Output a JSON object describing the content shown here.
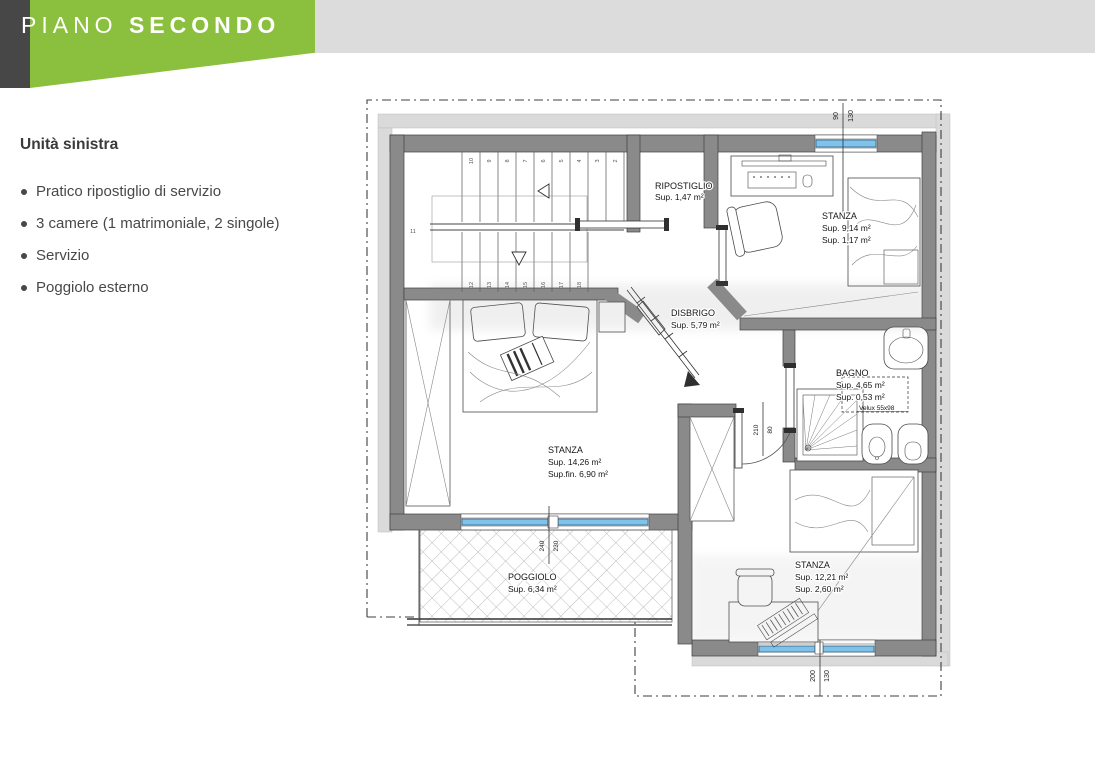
{
  "header": {
    "brand_light": "PIANO",
    "brand_bold": "SECONDO"
  },
  "sidebar": {
    "title": "Unità sinistra",
    "bullets": [
      "Pratico ripostiglio di servizio",
      "3 camere (1 matrimoniale, 2 singole)",
      "Servizio",
      "Poggiolo esterno"
    ]
  },
  "plan": {
    "rooms": {
      "ripostiglio": {
        "name": "RIPOSTIGLIO",
        "area": "Sup. 1,47 m²"
      },
      "stanza_nord": {
        "name": "STANZA",
        "area": "Sup. 9,14 m²",
        "area2": "Sup. 1,17 m²"
      },
      "disbrigo": {
        "name": "DISBRIGO",
        "area": "Sup. 5,79 m²"
      },
      "bagno": {
        "name": "BAGNO",
        "area": "Sup. 4,65 m²",
        "area2": "Sup. 0,53 m²",
        "velux": "Velux 55x98"
      },
      "stanza_matrimoniale": {
        "name": "STANZA",
        "area": "Sup. 14,26 m²",
        "area2": "Sup.fin. 6,90 m²"
      },
      "poggiolo": {
        "name": "POGGIOLO",
        "area": "Sup. 6,34 m²"
      },
      "stanza_sud": {
        "name": "STANZA",
        "area": "Sup. 12,21 m²",
        "area2": "Sup. 2,60 m²"
      }
    },
    "dims": {
      "window_top": [
        "90",
        "130"
      ],
      "door": [
        "210",
        "80"
      ],
      "balcony_window": [
        "240",
        "230"
      ],
      "window_bottom": [
        "200",
        "130"
      ]
    },
    "stairs": {
      "upper": [
        "10",
        "9",
        "8",
        "7",
        "6",
        "5",
        "4",
        "3",
        "2"
      ],
      "mid": "11",
      "lower": [
        "12",
        "13",
        "14",
        "15",
        "16",
        "17",
        "18"
      ]
    }
  },
  "colors": {
    "accent_green": "#8bc03e",
    "band_gray": "#dcdcdd",
    "sidebar_dark": "#474747",
    "wall_gray": "#8a8a8a",
    "window_blue": "#7fc3e9"
  }
}
